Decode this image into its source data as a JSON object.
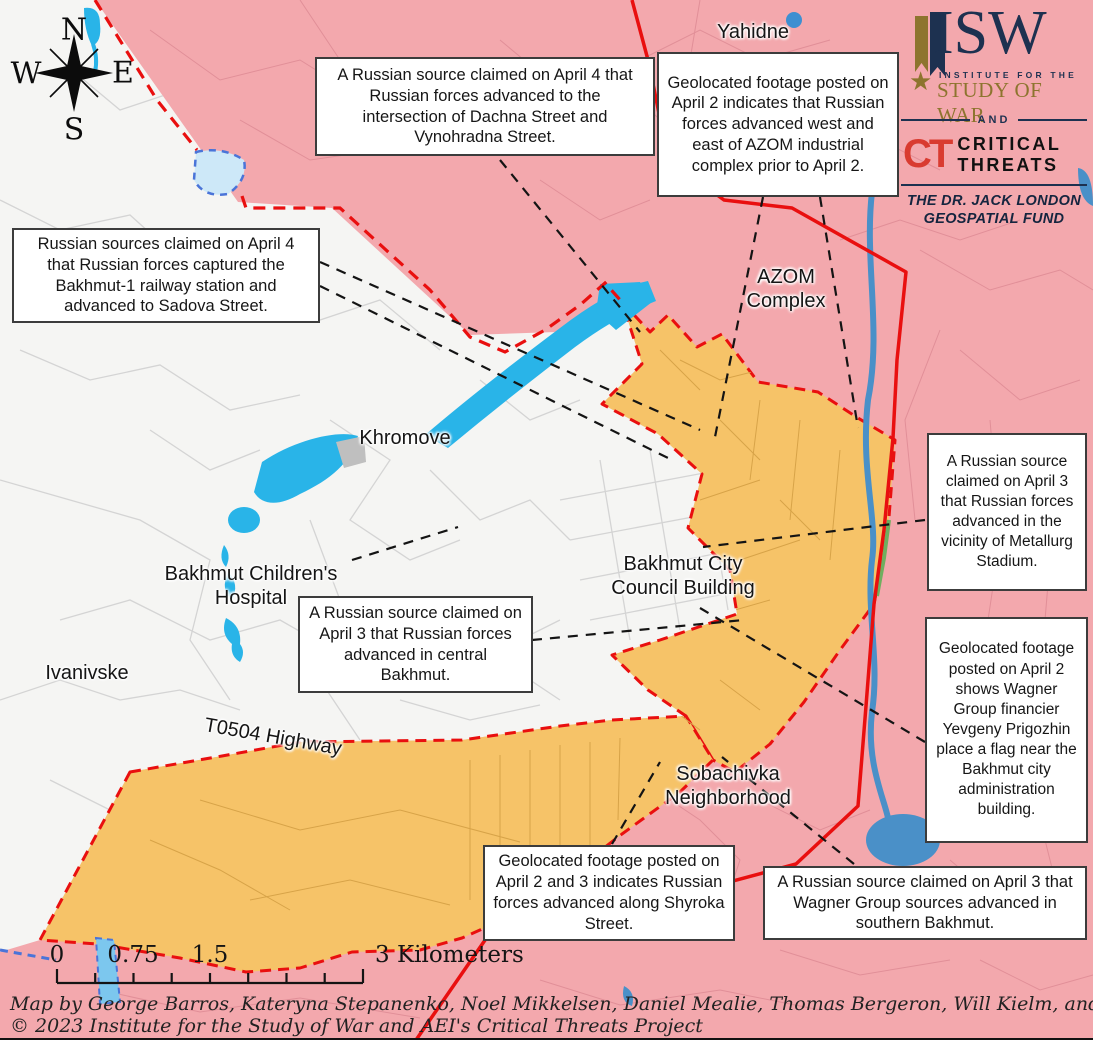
{
  "callouts": [
    {
      "text": "A Russian source claimed on April 4 that Russian forces advanced to the intersection of Dachna Street and Vynohradna Street."
    },
    {
      "text": "Geolocated footage posted on April 2 indicates that Russian forces advanced west and east of AZOM industrial complex prior to April 2."
    },
    {
      "text": "Russian sources claimed on April 4 that Russian forces captured the Bakhmut-1 railway station and advanced to Sadova Street."
    },
    {
      "text": "A Russian source claimed on April 3 that Russian forces advanced in central Bakhmut."
    },
    {
      "text": "A Russian source claimed on April 3 that Russian forces advanced in the vicinity of Metallurg Stadium."
    },
    {
      "text": "Geolocated footage posted on April 2 shows Wagner Group financier Yevgeny Prigozhin place a flag near the Bakhmut city administration building."
    },
    {
      "text": "Geolocated footage posted on April 2 and 3 indicates Russian forces advanced along Shyroka Street."
    },
    {
      "text": "A Russian source claimed on April 3 that Wagner Group sources advanced in southern Bakhmut."
    }
  ],
  "labels": [
    {
      "text": "Yahidne"
    },
    {
      "text": "AZOM\nComplex"
    },
    {
      "text": "Khromove"
    },
    {
      "text": "Bakhmut Children's\nHospital"
    },
    {
      "text": "Ivanivske"
    },
    {
      "text": "Bakhmut City\nCouncil Building"
    },
    {
      "text": "Sobachivka\nNeighborhood"
    },
    {
      "text": "T0504 Highway"
    }
  ],
  "compass": {
    "n": "N",
    "w": "W",
    "e": "E",
    "s": "S"
  },
  "scalebar": {
    "labels": [
      "0",
      "0.75",
      "1.5",
      "3 Kilometers"
    ]
  },
  "credits": {
    "line1": "Map by George Barros, Kateryna Stepanenko, Noel Mikkelsen, Daniel Mealie, Thomas Bergeron, Will Kielm, and Mitchell Belcher",
    "line2": "© 2023 Institute for the Study of War and AEI's Critical Threats Project"
  },
  "logo": {
    "isw": "ISW",
    "institute": "INSTITUTE FOR THE",
    "study": "STUDY OF WAR",
    "and": "AND",
    "ct": "CT",
    "critical": "CRITICAL",
    "threats": "THREATS",
    "fund": "THE DR. JACK LONDON GEOSPATIAL FUND",
    "star": "★"
  },
  "colors": {
    "russian_controlled_pink": "#f3a8ad",
    "claimed_advance_orange": "#f6c368",
    "contested_city_white": "#f5f5f3",
    "water_blue": "#29b4e8",
    "frontline_red": "#e90f0f",
    "leader_line_black": "#111111"
  }
}
